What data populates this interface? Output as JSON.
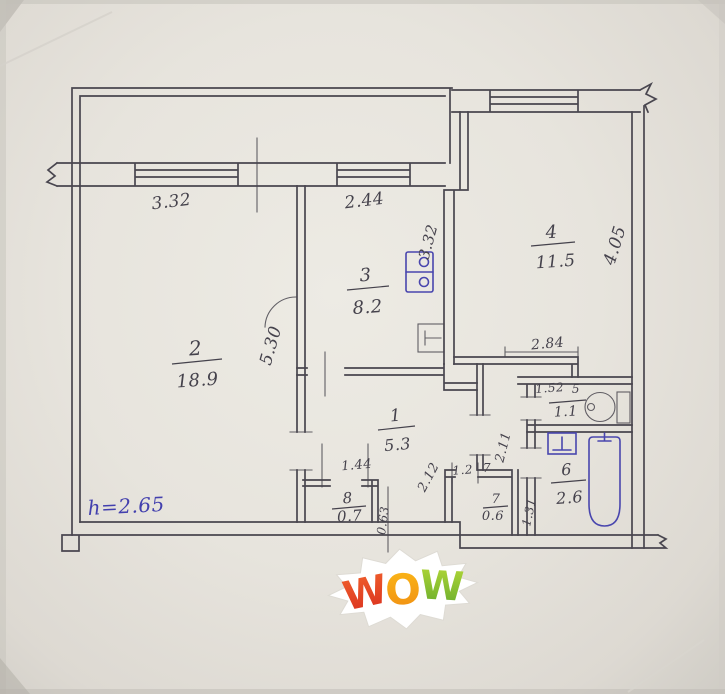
{
  "rooms": {
    "r1": {
      "number": "1",
      "area": "5.3"
    },
    "r2": {
      "number": "2",
      "area": "18.9"
    },
    "r3": {
      "number": "3",
      "area": "8.2"
    },
    "r4": {
      "number": "4",
      "area": "11.5"
    },
    "r5": {
      "number": "5",
      "area": "1.1"
    },
    "r6": {
      "number": "6",
      "area": "2.6"
    },
    "r7": {
      "number": "7",
      "area": "0.6"
    },
    "r8": {
      "number": "8",
      "area": "0.7"
    }
  },
  "dims": {
    "window_left": "3.32",
    "window_kitchen": "2.44",
    "kitchen_side": "3.32",
    "room4_side": "4.05",
    "room2_side": "5.30",
    "room4_width": "2.84",
    "wc_width": "1.52",
    "corridor_a": "2.11",
    "corridor_b": "2.12",
    "corridor_c": "1.31",
    "closet_width": "1.44",
    "closet_side": "0.63",
    "room7_width": "1.2"
  },
  "notes": {
    "ceiling_height": "h=2.65"
  },
  "watermark": {
    "letters": [
      "W",
      "O",
      "W"
    ]
  },
  "colors": {
    "ink": "#49464f",
    "blue_ink": "#4340ae",
    "paper": "#e7e4dd",
    "wow_red": "#e2402a",
    "wow_orange": "#f7a11c",
    "wow_green": "#8cc32f"
  },
  "fixtures": [
    "stove-icon",
    "kitchen-sink-icon",
    "toilet-icon",
    "bathtub-icon",
    "washbasin-icon"
  ]
}
